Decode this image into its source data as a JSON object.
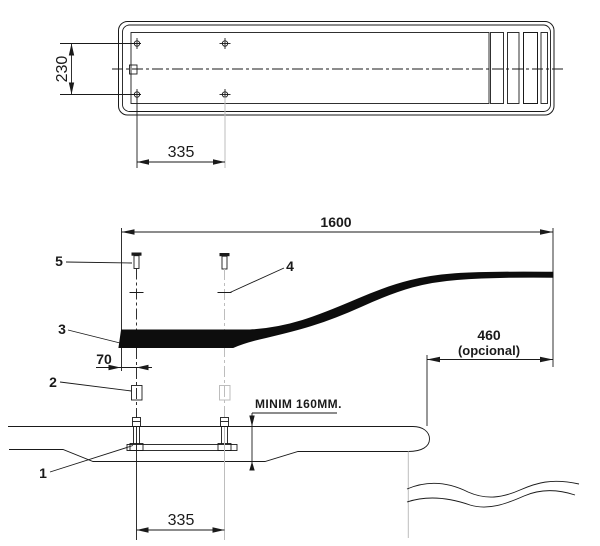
{
  "colors": {
    "line": "#1a1a1a",
    "light_line": "#bdbdbd",
    "fill": "#0d0d0d",
    "background": "#ffffff"
  },
  "top_view": {
    "dim_width": "230",
    "dim_bolt_spacing": "335"
  },
  "side_view": {
    "dim_total_length": "1600",
    "dim_overhang": "460",
    "dim_overhang_note": "(opcional)",
    "dim_front_offset": "70",
    "dim_min_embed": "MINIM 160MM.",
    "dim_bolt_spacing": "335",
    "part_labels": {
      "p1": "1",
      "p2": "2",
      "p3": "3",
      "p4": "4",
      "p5": "5"
    }
  }
}
